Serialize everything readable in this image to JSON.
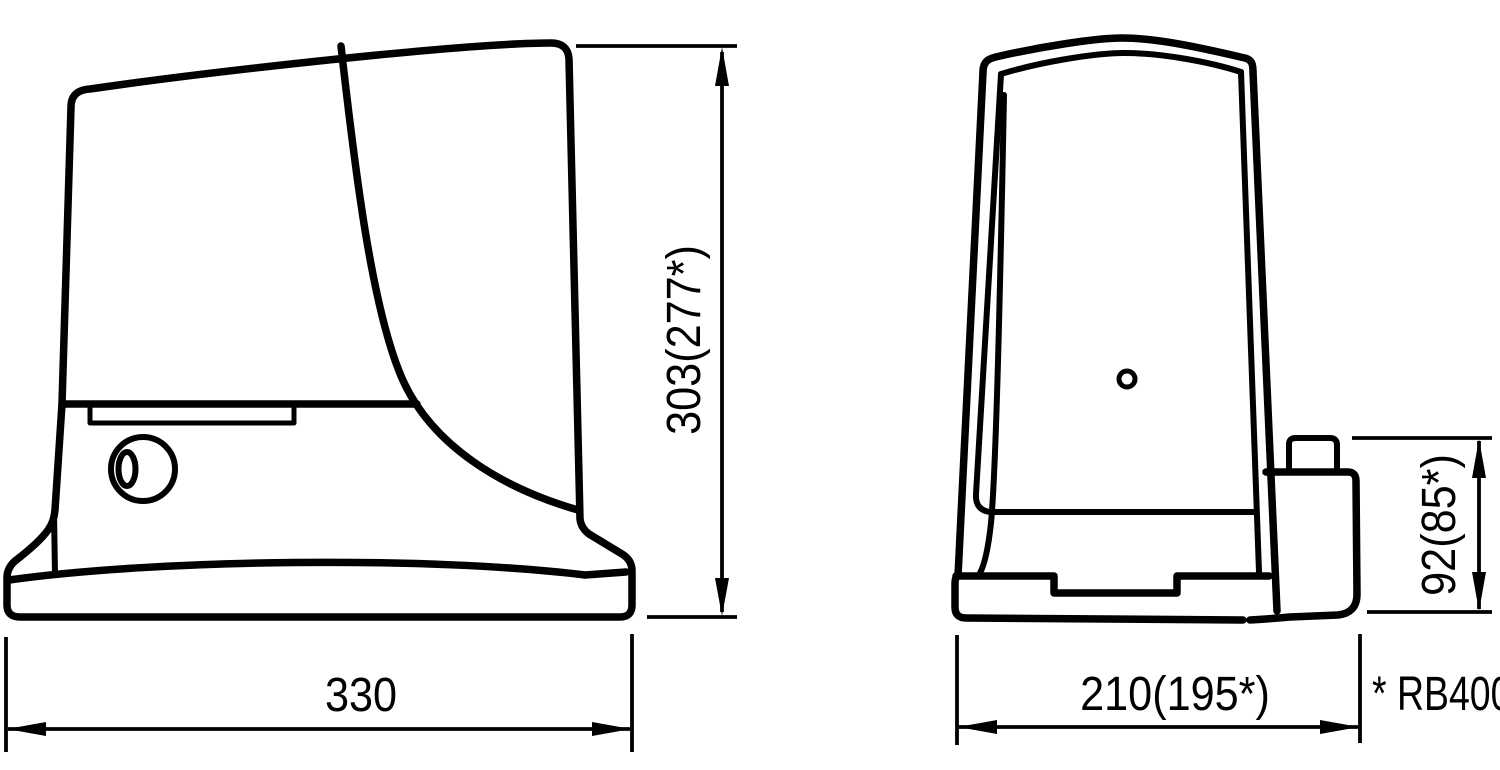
{
  "colors": {
    "ink": "#000000",
    "paper": "#ffffff"
  },
  "dimensions": {
    "side_height": "303(277*)",
    "side_width": "330",
    "front_width": "210(195*)",
    "front_block_height": "92(85*)"
  },
  "footnote": "* RB400"
}
